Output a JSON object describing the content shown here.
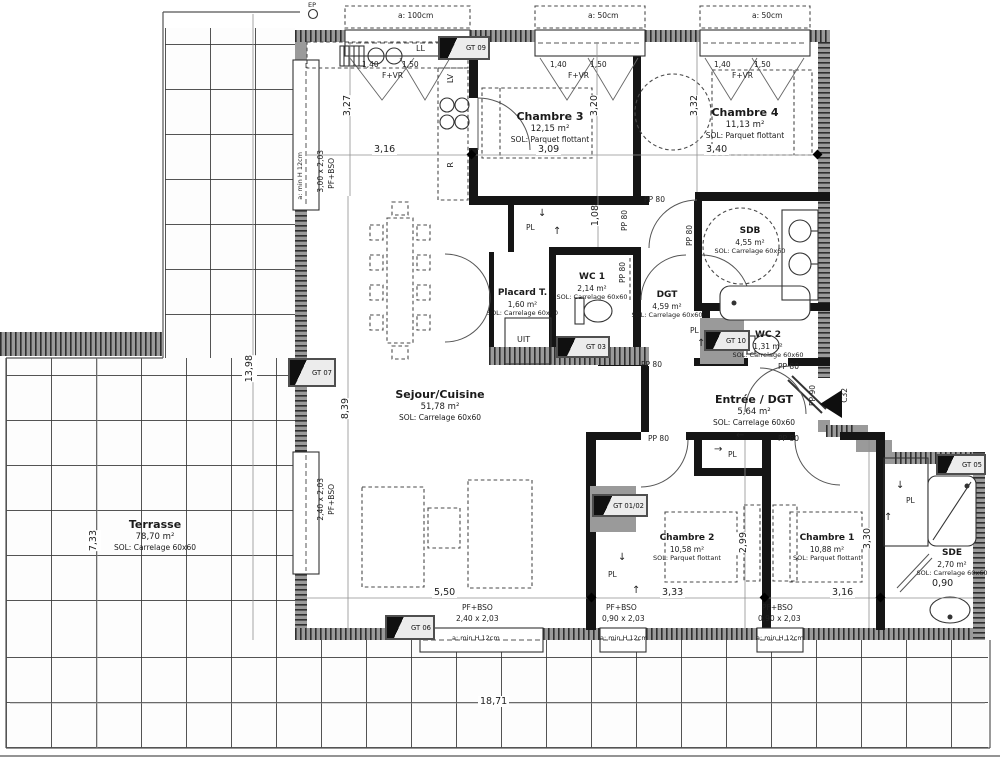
{
  "plan": {
    "rooms": {
      "terrasse": {
        "name": "Terrasse",
        "area": "78,70 m²",
        "floor": "SOL: Carrelage 60x60"
      },
      "sejour": {
        "name": "Sejour/Cuisine",
        "area": "51,78 m²",
        "floor": "SOL: Carrelage 60x60"
      },
      "chambre3": {
        "name": "Chambre 3",
        "area": "12,15 m²",
        "floor": "SOL: Parquet flottant"
      },
      "chambre4": {
        "name": "Chambre 4",
        "area": "11,13 m²",
        "floor": "SOL: Parquet flottant"
      },
      "sdb": {
        "name": "SDB",
        "area": "4,55 m²",
        "floor": "SOL: Carrelage 60x60"
      },
      "placard": {
        "name": "Placard T.",
        "area": "1,60 m²",
        "floor": "SOL: Carrelage 60x60"
      },
      "wc1": {
        "name": "WC 1",
        "area": "2,14 m²",
        "floor": "SOL: Carrelage 60x60"
      },
      "dgt": {
        "name": "DGT",
        "area": "4,59 m²",
        "floor": "SOL: Carrelage 60x60"
      },
      "wc2": {
        "name": "WC 2",
        "area": "1,31 m²",
        "floor": "SOL: Carrelage 60x60"
      },
      "entree": {
        "name": "Entrée / DGT",
        "area": "5,64 m²",
        "floor": "SOL: Carrelage 60x60"
      },
      "chambre2": {
        "name": "Chambre 2",
        "area": "10,58 m²",
        "floor": "SOL: Parquet flottant"
      },
      "chambre1": {
        "name": "Chambre 1",
        "area": "10,88 m²",
        "floor": "SOL: Parquet flottant"
      },
      "sde": {
        "name": "SDE",
        "area": "2,70 m²",
        "floor": "SOL: Carrelage 60x60"
      }
    },
    "dims": {
      "d327": "3,27",
      "d316top": "3,16",
      "d309": "3,09",
      "d320": "3,20",
      "d332": "3,32",
      "d340": "3,40",
      "d108": "1,08",
      "d839": "8,39",
      "d1398": "13,98",
      "d733": "7,33",
      "d550": "5,50",
      "d333": "3,33",
      "d316bot": "3,16",
      "d299": "2,99",
      "d330": "3,30",
      "d090": "0,90",
      "d1871": "18,71"
    },
    "win": {
      "a100": "a: 100cm",
      "a50": "a: 50cm",
      "s140": "1,40",
      "s150": "1,50",
      "fvr": "F+VR",
      "pfbso": "PF+BSO",
      "left1": "3,00 x 2,03",
      "left2": "2,40 x 2,03",
      "botc": "2,40 x 2,03",
      "bot90": "0,90 x 2,03",
      "amin": "a: min H 12cm"
    },
    "doors": {
      "pp80": "PP 80",
      "pp90": "PP 90",
      "c32": "C32"
    },
    "gt": {
      "gt09": "GT 09",
      "gt03": "GT 03",
      "gt10": "GT 10",
      "gt0102": "GT 01/02",
      "gt05": "GT 05",
      "gt06": "GT 06",
      "gt07": "GT 07"
    },
    "fx": {
      "ll": "LL",
      "lv": "LV",
      "r": "R",
      "uit": "UIT",
      "pl": "PL",
      "ep": "EP"
    },
    "arrows": {
      "up": "↑",
      "down": "↓",
      "left": "←",
      "right": "→"
    }
  }
}
